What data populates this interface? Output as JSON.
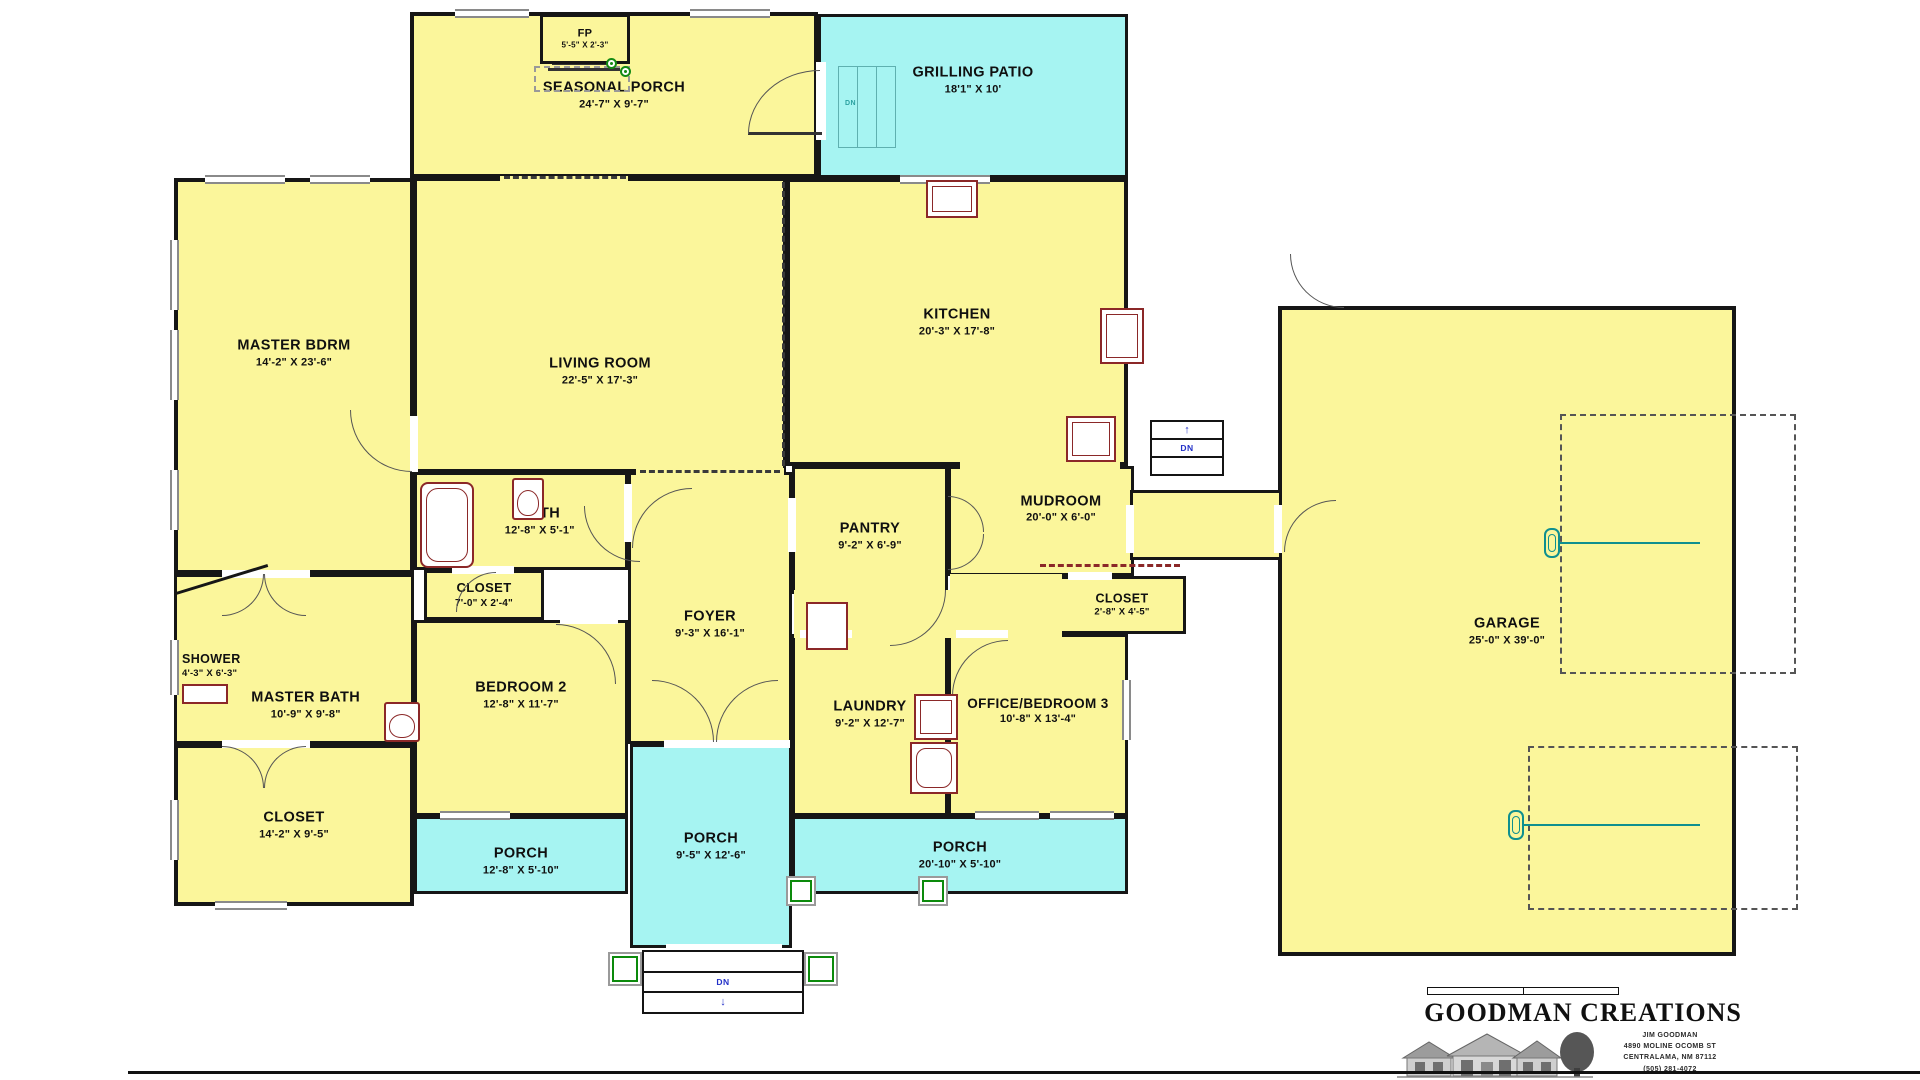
{
  "colors": {
    "room_yellow": "#FBF69B",
    "patio_cyan": "#A6F4F2",
    "wall": "#161616",
    "fixture_maroon": "#8B2828",
    "stair_blue": "#2230C8",
    "accent_green": "#0C8A0C",
    "accent_teal": "#0F8F8F"
  },
  "rooms": {
    "fp": {
      "name": "FP",
      "dims": "5'-5\" X 2'-3\""
    },
    "seasonal_porch": {
      "name": "SEASONAL PORCH",
      "dims": "24'-7\" X 9'-7\""
    },
    "grilling_patio": {
      "name": "GRILLING PATIO",
      "dims": "18'1\" X 10'"
    },
    "master_bdrm": {
      "name": "MASTER BDRM",
      "dims": "14'-2\" X 23'-6\""
    },
    "living_room": {
      "name": "LIVING ROOM",
      "dims": "22'-5\" X 17'-3\""
    },
    "kitchen": {
      "name": "KITCHEN",
      "dims": "20'-3\" X 17'-8\""
    },
    "bath": {
      "name": "BATH",
      "dims": "12'-8\" X 5'-1\""
    },
    "closet_hall": {
      "name": "CLOSET",
      "dims": "7'-0\" X 2'-4\""
    },
    "foyer": {
      "name": "FOYER",
      "dims": "9'-3\" X 16'-1\""
    },
    "pantry": {
      "name": "PANTRY",
      "dims": "9'-2\" X 6'-9\""
    },
    "mudroom": {
      "name": "MUDROOM",
      "dims": "20'-0\" X 6'-0\""
    },
    "closet_mud": {
      "name": "CLOSET",
      "dims": "2'-8\" X 4'-5\""
    },
    "shower": {
      "name": "SHOWER",
      "dims": "4'-3\" X 6'-3\""
    },
    "master_bath": {
      "name": "MASTER BATH",
      "dims": "10'-9\" X 9'-8\""
    },
    "bedroom2": {
      "name": "BEDROOM 2",
      "dims": "12'-8\" X 11'-7\""
    },
    "laundry": {
      "name": "LAUNDRY",
      "dims": "9'-2\" X 12'-7\""
    },
    "office_bedroom3": {
      "name": "OFFICE/BEDROOM 3",
      "dims": "10'-8\" X 13'-4\""
    },
    "closet_master": {
      "name": "CLOSET",
      "dims": "14'-2\" X 9'-5\""
    },
    "porch_left": {
      "name": "PORCH",
      "dims": "12'-8\" X 5'-10\""
    },
    "porch_center": {
      "name": "PORCH",
      "dims": "9'-5\" X 12'-6\""
    },
    "porch_right": {
      "name": "PORCH",
      "dims": "20'-10\" X 5'-10\""
    },
    "garage": {
      "name": "GARAGE",
      "dims": "25'-0\" X 39'-0\""
    }
  },
  "annotations": {
    "dn": "DN",
    "up": "↑",
    "down": "↓"
  },
  "logo": {
    "title": "GOODMAN CREATIONS",
    "line1": "JIM GOODMAN",
    "line2": "4890 MOLINE OCOMB ST",
    "line3": "CENTRALAMA, NM 87112",
    "line4": "(505) 281-4072"
  }
}
